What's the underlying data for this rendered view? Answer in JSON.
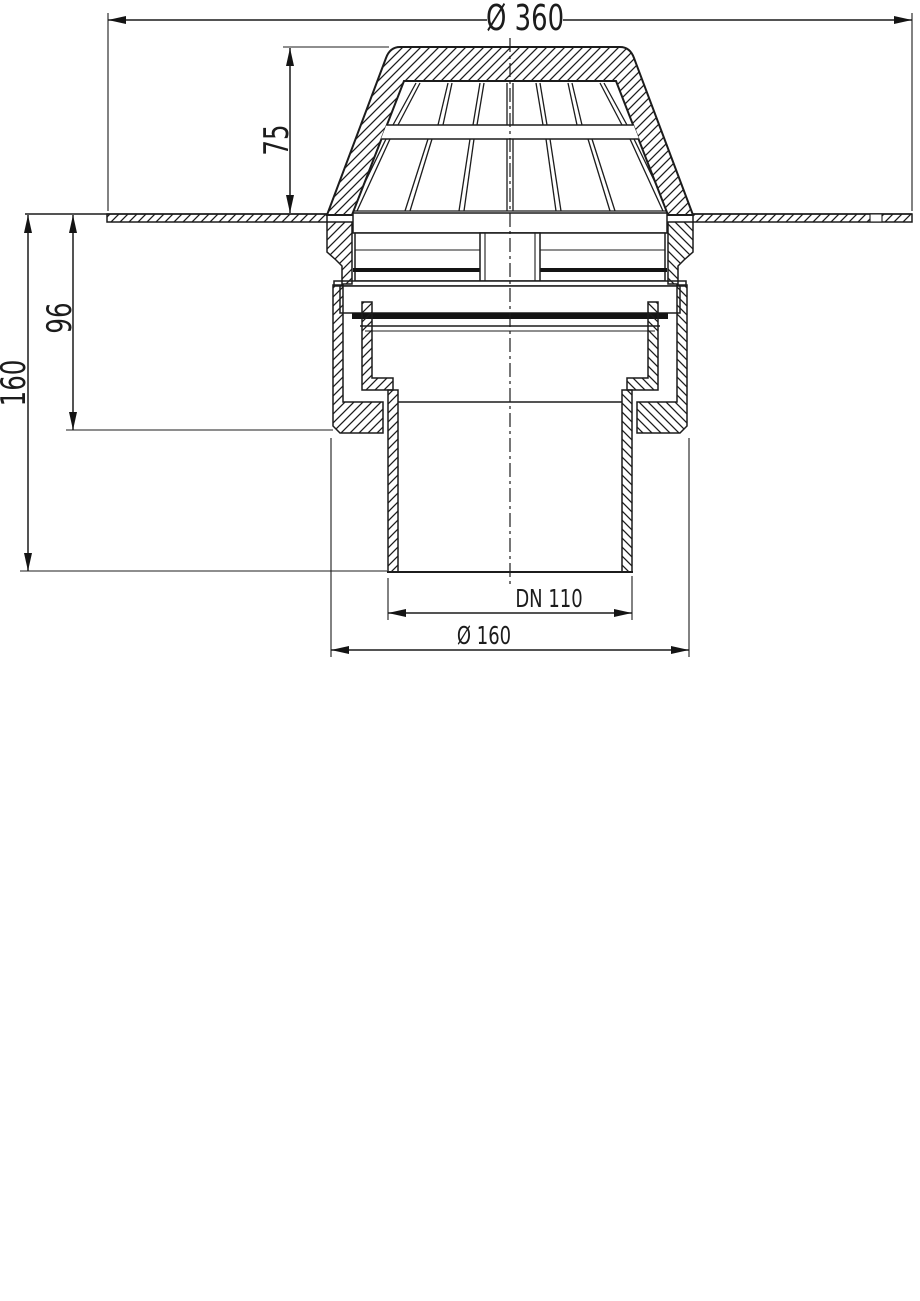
{
  "page": {
    "background": "#ffffff",
    "line_color": "#1c1c1c"
  },
  "drawing": {
    "title": "Roof drain cross-section technical drawing",
    "view": "front sectional view",
    "components": [
      "dome grate hood",
      "roof flange plate",
      "grate base ring",
      "seal clamping ring",
      "drain body",
      "union nut",
      "outlet pipe",
      "center line"
    ],
    "dimensions": {
      "outer_diameter": {
        "label": "Ø 360",
        "value": 360,
        "unit": "mm",
        "orientation": "horizontal",
        "location": "top"
      },
      "dome_height": {
        "label": "75",
        "value": 75,
        "unit": "mm",
        "orientation": "vertical",
        "location": "upper-left"
      },
      "upper_body_height": {
        "label": "96",
        "value": 96,
        "unit": "mm",
        "orientation": "vertical",
        "location": "left"
      },
      "total_height": {
        "label": "160",
        "value": 160,
        "unit": "mm",
        "orientation": "vertical",
        "location": "far-left"
      },
      "outlet_nominal_size": {
        "label": "DN 110",
        "value": "DN 110",
        "orientation": "horizontal",
        "location": "bottom"
      },
      "lower_diameter": {
        "label": "Ø 160",
        "value": 160,
        "unit": "mm",
        "orientation": "horizontal",
        "location": "bottom"
      }
    }
  }
}
